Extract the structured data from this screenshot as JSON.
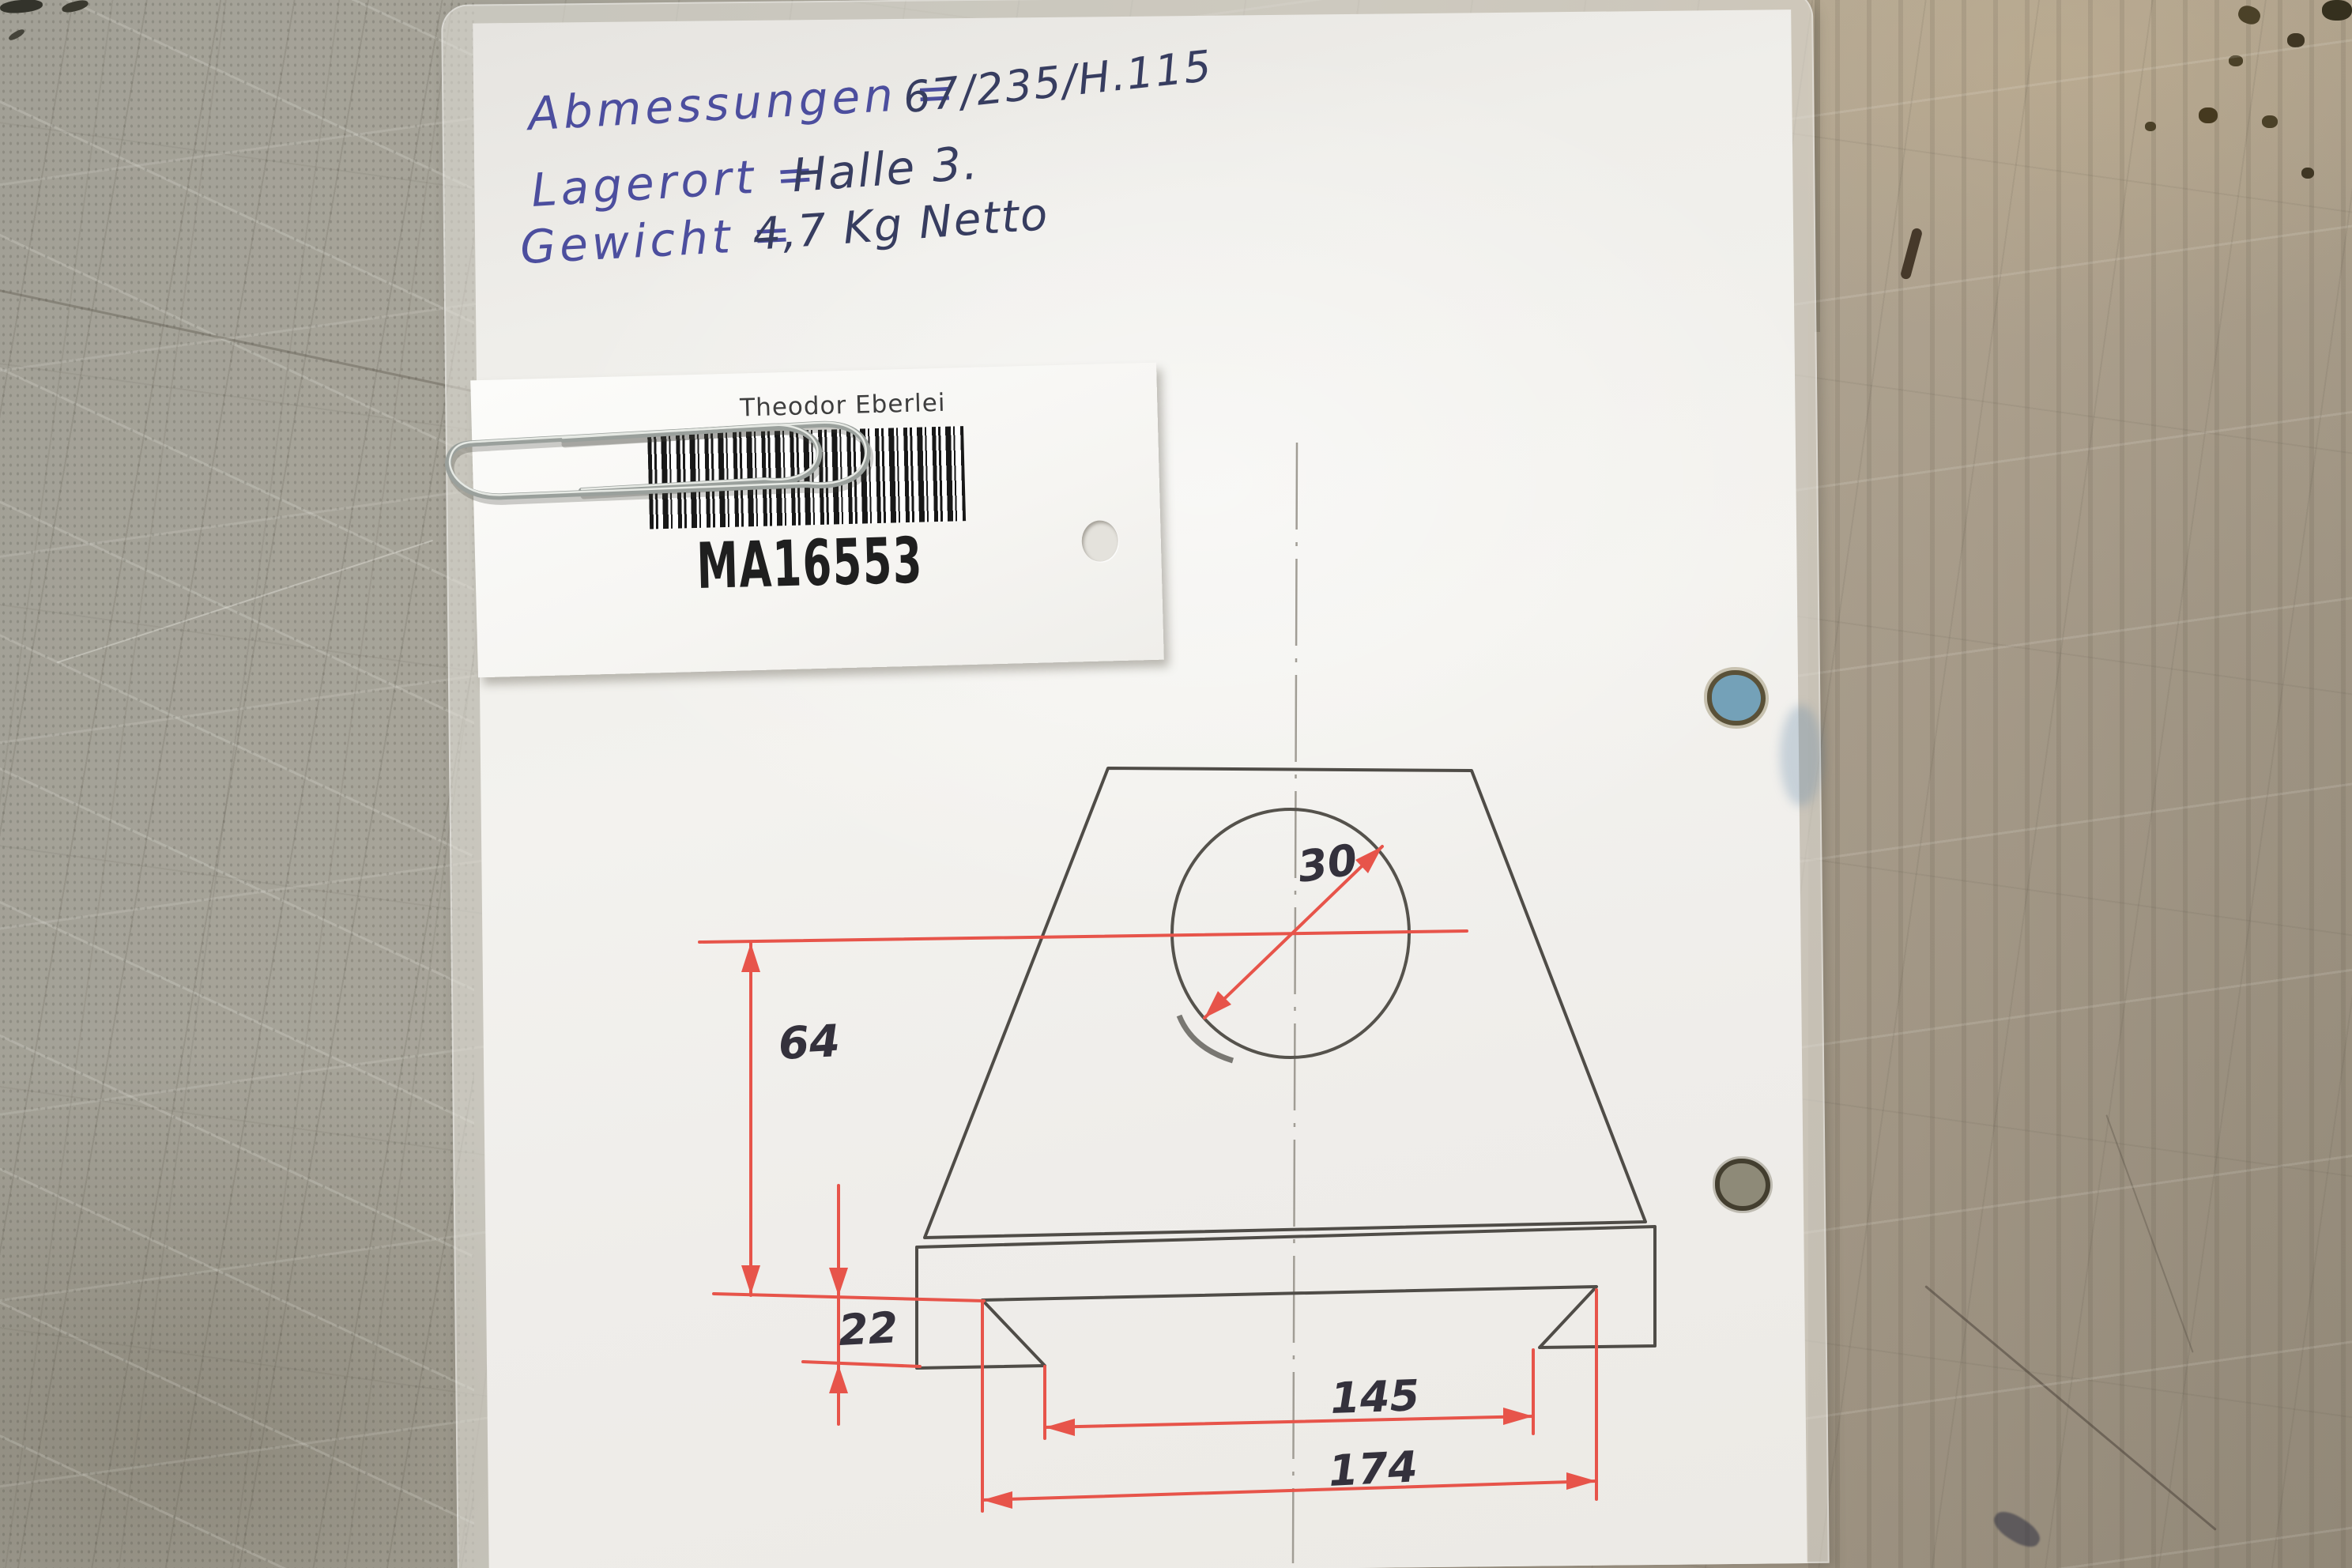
{
  "notes": {
    "lines": [
      {
        "label": "Abmessungen =",
        "value": "67/235/H.115"
      },
      {
        "label": "Lagerort =",
        "value": "Halle 3."
      },
      {
        "label": "Gewicht =",
        "value": "4,7 Kg Netto"
      }
    ],
    "ink_label_color": "#4c4e9e",
    "ink_value_color": "#373d60"
  },
  "tag": {
    "owner": "Theodor Eberlei",
    "code": "MA16553"
  },
  "drawing": {
    "dimensions": {
      "hole_diameter": "30",
      "height": "64",
      "foot_height": "22",
      "inner_width": "145",
      "outer_width": "174"
    },
    "dimension_line_color": "#e7544a",
    "pencil_color": "#4f4c47",
    "centerline_color": "#a19d95"
  }
}
